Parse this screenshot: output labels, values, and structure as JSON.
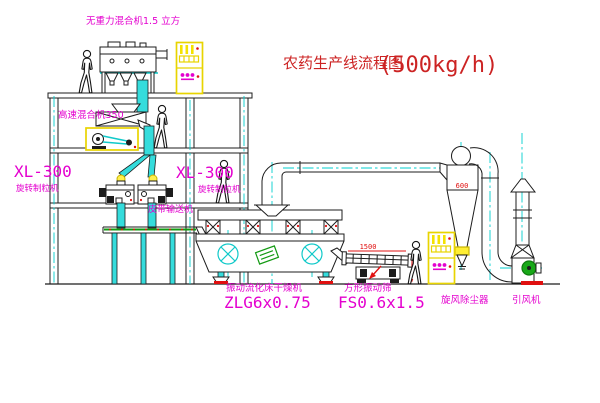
{
  "title": {
    "main": "农药生产线流程图",
    "capacity": "(500kg/h)"
  },
  "equipment_labels": {
    "gravity_mixer": "无重力混合机1.5 立方",
    "high_speed_mixer": "高速混合机350",
    "granulator_left_model": "XL-300",
    "granulator_left_name": "旋转制粒机",
    "granulator_mid_model": "XL-300",
    "granulator_mid_name": "旋转制粒机",
    "belt_conveyor": "皮带输送机",
    "dryer_name": "振动流化床干燥机",
    "dryer_model": "ZLG6x0.75",
    "sieve_name": "方形振动筛",
    "sieve_model": "FS0.6x1.5",
    "cyclone_name": "旋风除尘器",
    "fan_name": "引风机"
  },
  "dimensions": {
    "cyclone_width": "600",
    "sieve_length": "1500"
  },
  "colors": {
    "label_magenta": "#e400cf",
    "title_red": "#cc2323",
    "dimension_red": "#e01010",
    "centerline_cyan": "#00cfcf",
    "chute_cyan": "#35dcdc",
    "cabinet_yellow": "#f4e200",
    "motor_green": "#18a818"
  }
}
